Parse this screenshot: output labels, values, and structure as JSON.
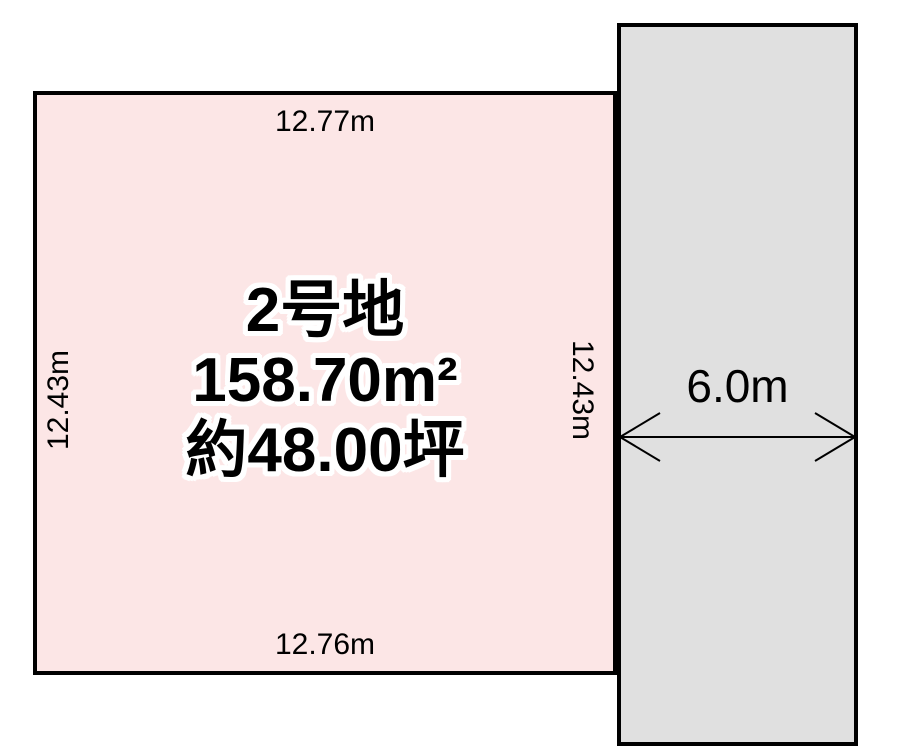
{
  "diagram": {
    "title": "land-plot-layout",
    "plot": {
      "name": "2号地",
      "area_m2": "158.70m²",
      "area_tsubo": "約48.00坪",
      "dim_top": "12.77m",
      "dim_bottom": "12.76m",
      "dim_left": "12.43m",
      "dim_right": "12.43m",
      "fill_color": "#fce6e6"
    },
    "road": {
      "width_label": "6.0m",
      "fill_color": "#e0e0e0"
    },
    "colors": {
      "outline": "#000000",
      "background": "#ffffff",
      "text": "#000000",
      "caption_halo": "#ffffff"
    }
  }
}
